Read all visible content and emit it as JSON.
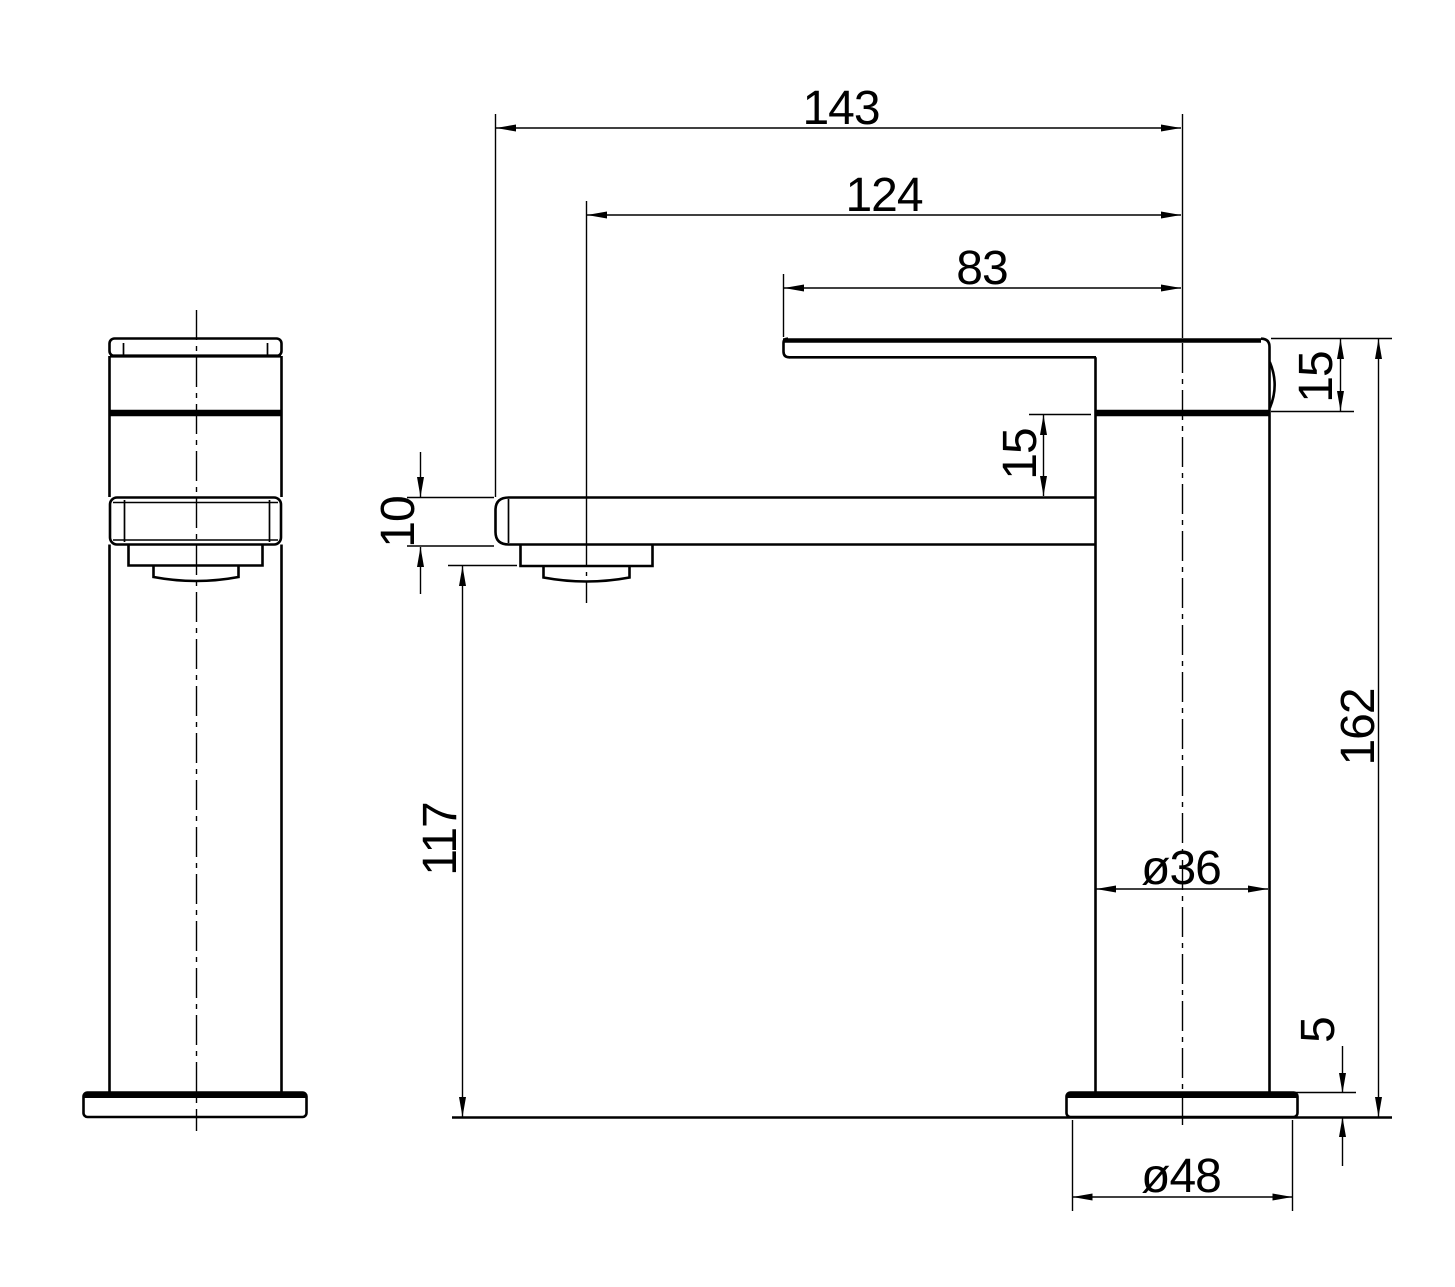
{
  "drawing": {
    "background": "#ffffff",
    "line_color": "#000000",
    "dimensions": {
      "reach_overall": "143",
      "reach_to_aerator_center": "124",
      "spout_span": "83",
      "spout_thickness": "15",
      "head_to_deck_gap": "15",
      "deck_plate_thickness": "10",
      "height_under_aerator": "117",
      "height_overall": "162",
      "body_diameter": "ø36",
      "base_plate_height": "5",
      "base_diameter": "ø48"
    }
  }
}
